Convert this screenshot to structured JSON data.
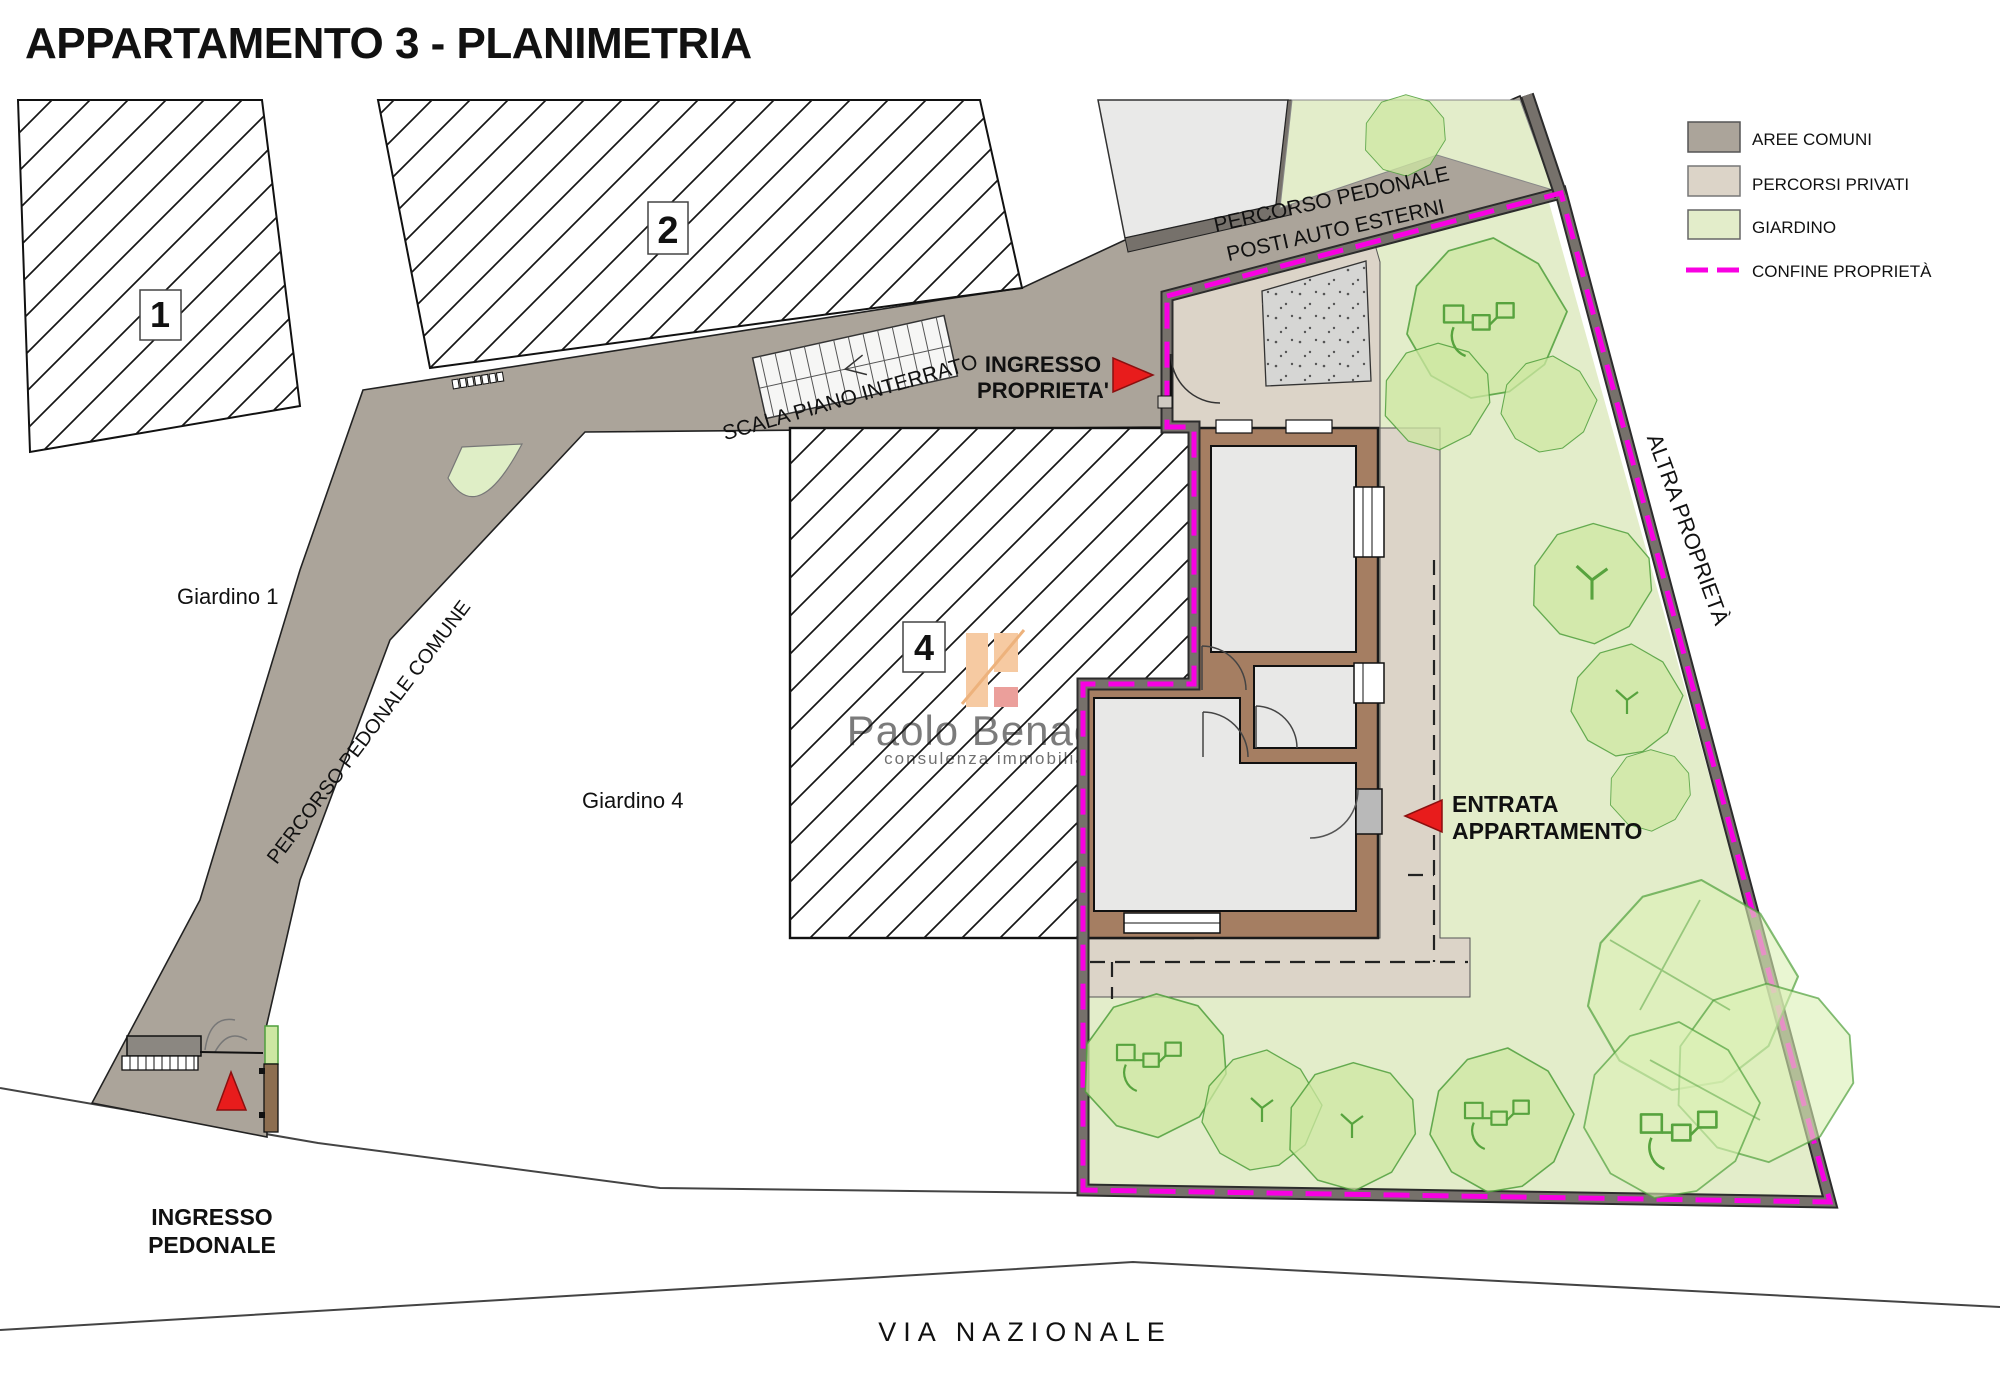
{
  "title": "APPARTAMENTO 3 - PLANIMETRIA",
  "legend": {
    "items": [
      {
        "label": "AREE COMUNI",
        "color": "#aba49a"
      },
      {
        "label": "PERCORSI PRIVATI",
        "color": "#dcd4c8"
      },
      {
        "label": "GIARDINO",
        "color": "#e3edca"
      },
      {
        "label": "CONFINE PROPRIETÀ",
        "color": "#f800e2"
      }
    ]
  },
  "labels": {
    "giardino1": "Giardino 1",
    "giardino4": "Giardino 4",
    "altra_proprieta": "ALTRA PROPRIETÀ",
    "via_nazionale": "VIA NAZIONALE",
    "percorso_comune": "PERCORSO PEDONALE COMUNE",
    "percorso_posti_1": "PERCORSO PEDONALE",
    "percorso_posti_2": "POSTI AUTO ESTERNI",
    "scala": "SCALA PIANO INTERRATO",
    "ingresso_proprieta_1": "INGRESSO",
    "ingresso_proprieta_2": "PROPRIETA'",
    "entrata_1": "ENTRATA",
    "entrata_2": "APPARTAMENTO",
    "ingresso_pedonale_1": "INGRESSO",
    "ingresso_pedonale_2": "PEDONALE"
  },
  "buildings": {
    "b1": "1",
    "b2": "2",
    "b4": "4"
  },
  "watermark": {
    "name": "Paolo Benaglio",
    "tagline": "consulenza immobiliare"
  },
  "colors": {
    "boundary_magenta": "#f800e2",
    "arrow_red": "#e81c1c",
    "wall_brown": "#a57e62",
    "aree_comuni": "#aba49a",
    "percorsi_privati": "#dcd4c8",
    "giardino": "#e3edca"
  }
}
